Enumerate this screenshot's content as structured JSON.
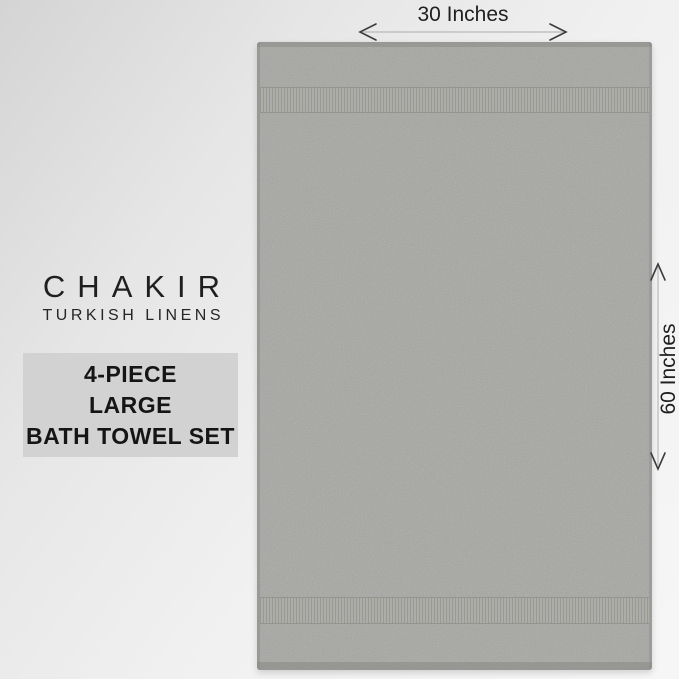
{
  "brand": {
    "name": "CHAKIR",
    "tagline": "TURKISH LINENS"
  },
  "product_title": {
    "line1": "4-PIECE",
    "line2": "LARGE",
    "line3": "BATH TOWEL SET"
  },
  "dimensions": {
    "width": "30 Inches",
    "height": "60 Inches"
  },
  "colors": {
    "bg_dark": "#d4d4d4",
    "bg_light": "#f6f6f6",
    "towel_base": "#a6a6a3",
    "towel_band": "#aeaeab",
    "towel_edge": "#8a8a87",
    "box_bg": "#d2d2d2",
    "arrow_line": "#b9b9b9",
    "arrow_head": "#3c3c3c",
    "text_dark": "#1f1f1f"
  }
}
